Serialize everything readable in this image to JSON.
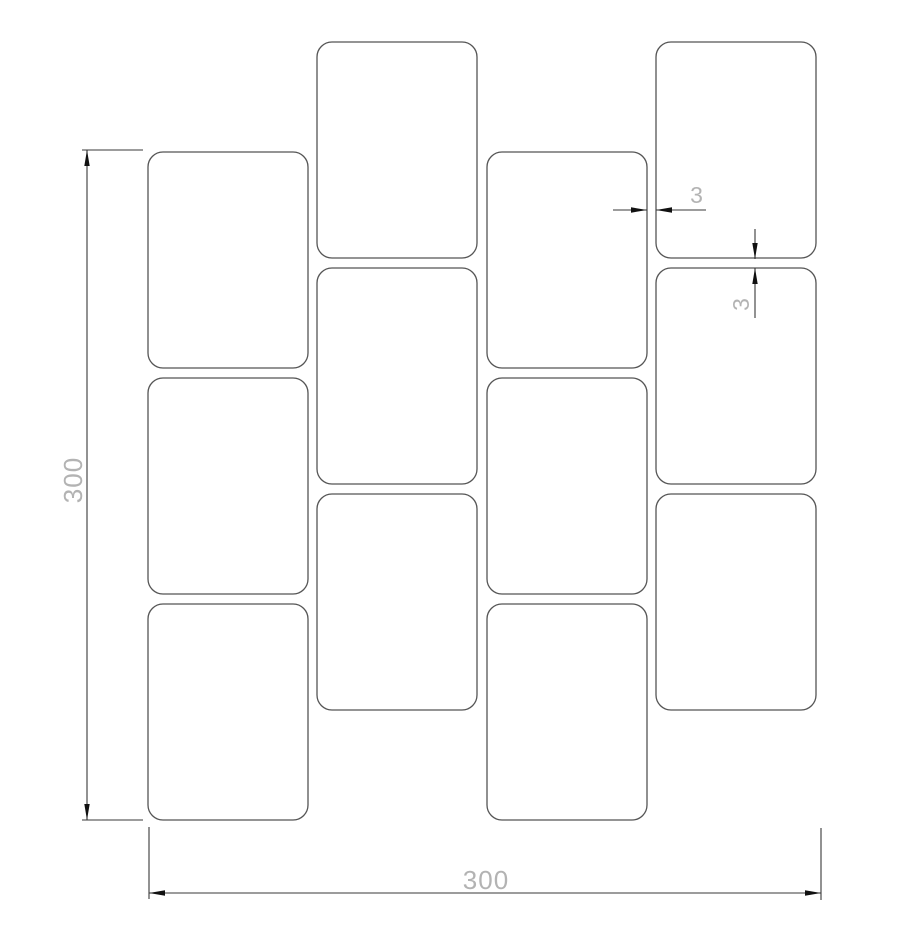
{
  "drawing": {
    "canvas": {
      "width": 900,
      "height": 930,
      "background": "#ffffff"
    },
    "colors": {
      "tile_stroke": "#555555",
      "tile_fill": "#ffffff",
      "dim_line": "#3a3a3a",
      "arrow_fill": "#111111",
      "dim_text": "#b3b3b3"
    },
    "tiles": {
      "corner_radius": 15,
      "width": 160,
      "height": 216,
      "items": [
        {
          "x": 148,
          "y": 152
        },
        {
          "x": 148,
          "y": 378
        },
        {
          "x": 148,
          "y": 604
        },
        {
          "x": 317,
          "y": 42
        },
        {
          "x": 317,
          "y": 268
        },
        {
          "x": 317,
          "y": 494
        },
        {
          "x": 487,
          "y": 152
        },
        {
          "x": 487,
          "y": 378
        },
        {
          "x": 487,
          "y": 604
        },
        {
          "x": 656,
          "y": 42
        },
        {
          "x": 656,
          "y": 268
        },
        {
          "x": 656,
          "y": 494
        }
      ]
    },
    "dimensions": [
      {
        "id": "overall-height",
        "label": "300",
        "text": {
          "x": 73,
          "y": 480,
          "rotate": -90,
          "size": 26
        },
        "segments": [
          {
            "x1": 87,
            "y1": 150,
            "x2": 87,
            "y2": 820
          },
          {
            "x1": 82,
            "y1": 150,
            "x2": 143,
            "y2": 150
          },
          {
            "x1": 82,
            "y1": 820,
            "x2": 143,
            "y2": 820
          }
        ],
        "arrows": [
          {
            "x": 87,
            "y": 150,
            "dir": "up"
          },
          {
            "x": 87,
            "y": 820,
            "dir": "down"
          }
        ]
      },
      {
        "id": "overall-width",
        "label": "300",
        "text": {
          "x": 486,
          "y": 880,
          "rotate": 0,
          "size": 26
        },
        "segments": [
          {
            "x1": 149,
            "y1": 893,
            "x2": 821,
            "y2": 893
          },
          {
            "x1": 149,
            "y1": 827,
            "x2": 149,
            "y2": 899
          },
          {
            "x1": 821,
            "y1": 828,
            "x2": 821,
            "y2": 900
          }
        ],
        "arrows": [
          {
            "x": 149,
            "y": 893,
            "dir": "left"
          },
          {
            "x": 821,
            "y": 893,
            "dir": "right"
          }
        ]
      },
      {
        "id": "joint-gap-horizontal",
        "label": "3",
        "text": {
          "x": 697,
          "y": 195,
          "rotate": 0,
          "size": 23
        },
        "segments": [
          {
            "x1": 613,
            "y1": 210,
            "x2": 647,
            "y2": 210
          },
          {
            "x1": 656,
            "y1": 210,
            "x2": 706,
            "y2": 210
          }
        ],
        "arrows": [
          {
            "x": 647,
            "y": 210,
            "dir": "right"
          },
          {
            "x": 656,
            "y": 210,
            "dir": "left"
          }
        ]
      },
      {
        "id": "joint-gap-vertical",
        "label": "3",
        "text": {
          "x": 741,
          "y": 304,
          "rotate": -90,
          "size": 23
        },
        "segments": [
          {
            "x1": 755,
            "y1": 229,
            "x2": 755,
            "y2": 259
          },
          {
            "x1": 755,
            "y1": 268,
            "x2": 755,
            "y2": 318
          }
        ],
        "arrows": [
          {
            "x": 755,
            "y": 259,
            "dir": "down"
          },
          {
            "x": 755,
            "y": 268,
            "dir": "up"
          }
        ]
      }
    ]
  }
}
